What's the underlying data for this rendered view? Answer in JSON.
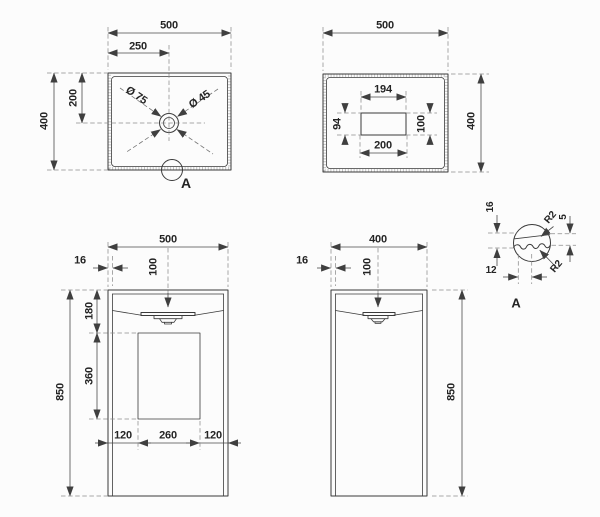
{
  "views": {
    "top": {
      "total_width": "500",
      "center_offset_x": "250",
      "total_depth": "400",
      "center_offset_y": "200",
      "dia_outer": "Ø 75",
      "dia_inner": "Ø 45",
      "detail_ref": "A"
    },
    "bottom": {
      "total_width": "500",
      "total_depth": "400",
      "cutout_top": "194",
      "cutout_left": "94",
      "cutout_right": "100",
      "cutout_bottom": "200"
    },
    "front": {
      "total_width": "500",
      "wall_thickness": "16",
      "basin_depth": "100",
      "top_to_recess": "180",
      "recess_height": "360",
      "total_height": "850",
      "recess_margin_left": "120",
      "recess_width": "260",
      "recess_margin_right": "120"
    },
    "side": {
      "total_depth": "400",
      "wall_thickness": "16",
      "basin_depth": "100",
      "total_height": "850"
    },
    "detail": {
      "rim_height": "16",
      "radius_top": "R2",
      "edge_offset": "5",
      "radius_bottom": "R2",
      "wave_pitch": "12",
      "title": "A"
    }
  },
  "colors": {
    "object_line": "#3a3a3a",
    "dimension_line": "#4a4a4a",
    "extension_line": "#8a8a8a",
    "text": "#242424",
    "background": "#fcfcfc"
  }
}
